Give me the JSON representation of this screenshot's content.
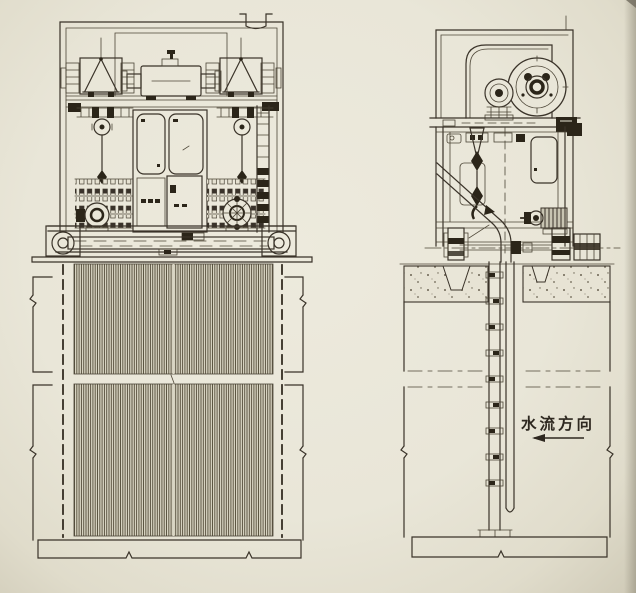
{
  "page": {
    "paper_color": "#e9e6d8",
    "ink_color": "#3a3329",
    "dark_fill_color": "#2b2519",
    "grid_bar_color": "#57503d"
  },
  "annotations": {
    "flow_direction": {
      "text": "水流方向",
      "arrow_direction": "left"
    }
  }
}
